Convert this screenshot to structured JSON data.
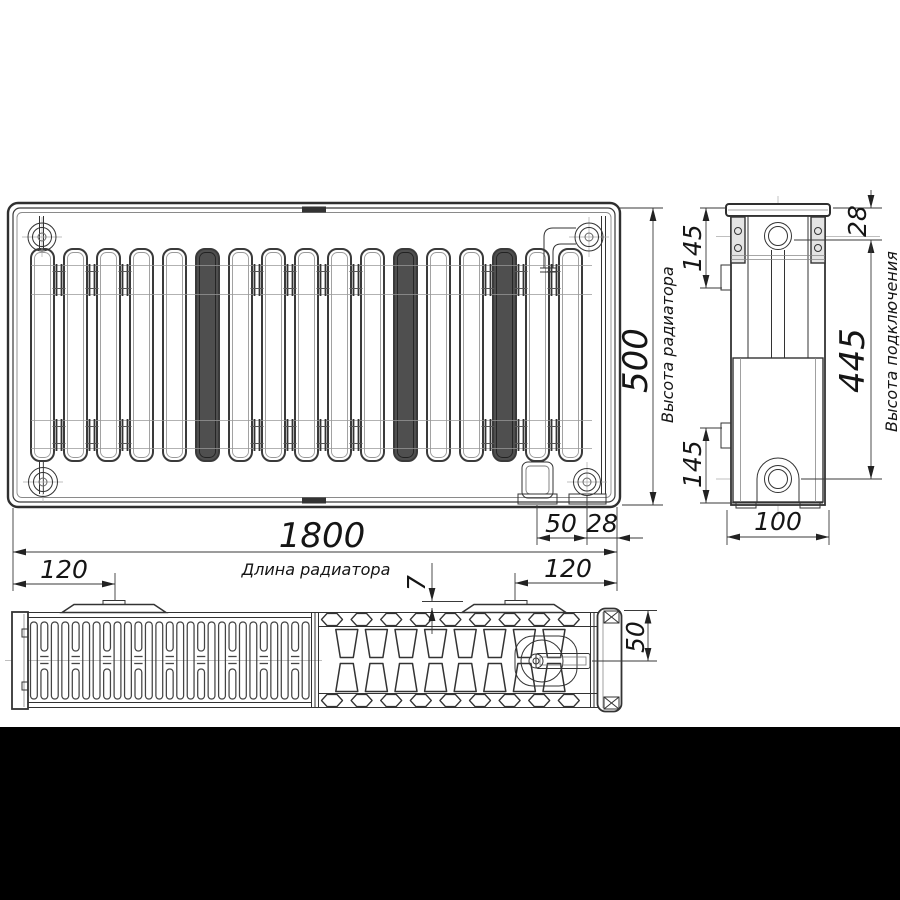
{
  "drawing": {
    "type": "radiator-technical-drawing",
    "dimensions": {
      "length": {
        "value": "1800",
        "label": "Длина радиатора"
      },
      "height": {
        "value": "500",
        "label": "Высота радиатора"
      },
      "connection_height": {
        "value": "445",
        "label": "Высота подключения"
      },
      "top_port_offset": {
        "value": "28"
      },
      "bracket_offset_top": {
        "value": "145"
      },
      "bracket_offset_bottom": {
        "value": "145"
      },
      "depth": {
        "value": "100"
      },
      "outlet_offset_50": {
        "value": "50"
      },
      "outlet_offset_28": {
        "value": "28"
      },
      "clip_offset_left": {
        "value": "120"
      },
      "clip_offset_right": {
        "value": "120"
      },
      "panel_gap": {
        "value": "7"
      },
      "valve_axis_depth": {
        "value": "50"
      }
    },
    "colors": {
      "line": "#333333",
      "text": "#151515",
      "background": "#ffffff",
      "letterbox_band": "#000000"
    }
  }
}
